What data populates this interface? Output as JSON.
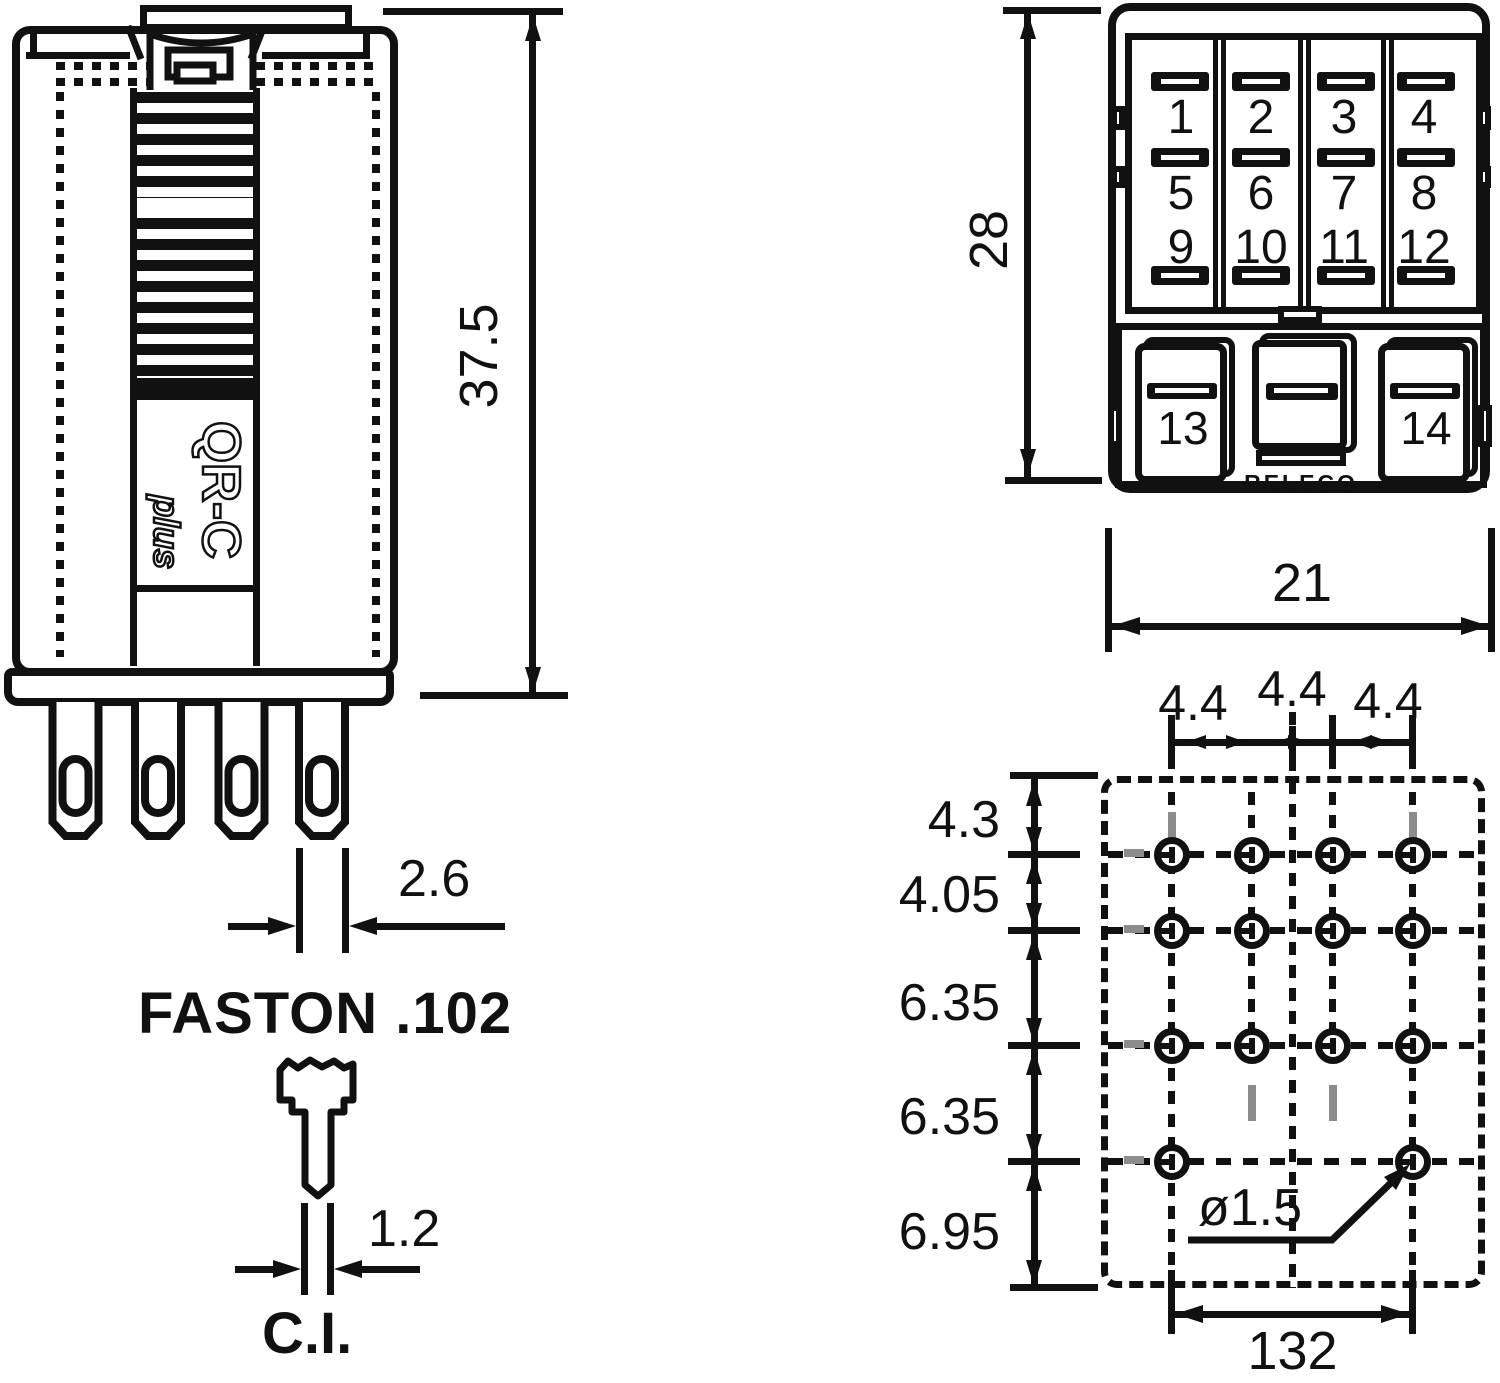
{
  "side_view": {
    "model": "QR-C",
    "model_variant": "plus",
    "height_dim": "37.5",
    "terminal_width_dim": "2.6",
    "terminal_type": "FASTON .102",
    "ci_width_dim": "1.2",
    "ci_label": "C.I."
  },
  "bottom_view": {
    "brand": "RELECO",
    "height_dim": "28",
    "width_dim": "21",
    "terminals": [
      "1",
      "2",
      "3",
      "4",
      "5",
      "6",
      "7",
      "8",
      "9",
      "10",
      "11",
      "12"
    ],
    "coil_terminals": [
      "13",
      "14"
    ]
  },
  "pin_layout": {
    "column_spacing_dims": [
      "4.4",
      "4.4",
      "4.4"
    ],
    "row_spacing_dims": [
      "4.3",
      "4.05",
      "6.35",
      "6.35",
      "6.95"
    ],
    "hole_diameter_dim": "ø1.5",
    "overall_width_dim": "132"
  },
  "colors": {
    "ink": "#111111",
    "gray": "#8c8c8c",
    "background": "#ffffff"
  }
}
